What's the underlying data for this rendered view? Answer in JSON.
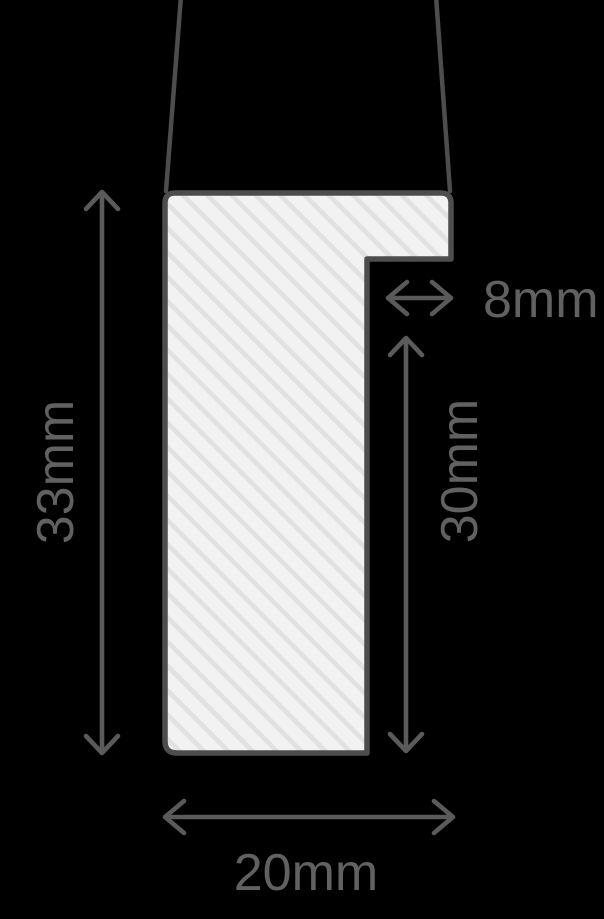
{
  "diagram": {
    "kind": "frame-moulding-profile-cross-section",
    "background_color": "#000000",
    "profile": {
      "outline_color": "#4d4d4d",
      "fill_color": "#f2f2f2",
      "hatch_color": "#e1e1e1"
    },
    "dimension_color": "#5a5a5a",
    "label_color": "#616161",
    "dimensions": {
      "overall_height": {
        "label": "33mm",
        "value": 33,
        "unit": "mm",
        "orientation": "vertical"
      },
      "rebate_width": {
        "label": "8mm",
        "value": 8,
        "unit": "mm",
        "orientation": "horizontal"
      },
      "rebate_height": {
        "label": "30mm",
        "value": 30,
        "unit": "mm",
        "orientation": "vertical"
      },
      "overall_width": {
        "label": "20mm",
        "value": 20,
        "unit": "mm",
        "orientation": "horizontal"
      }
    }
  }
}
